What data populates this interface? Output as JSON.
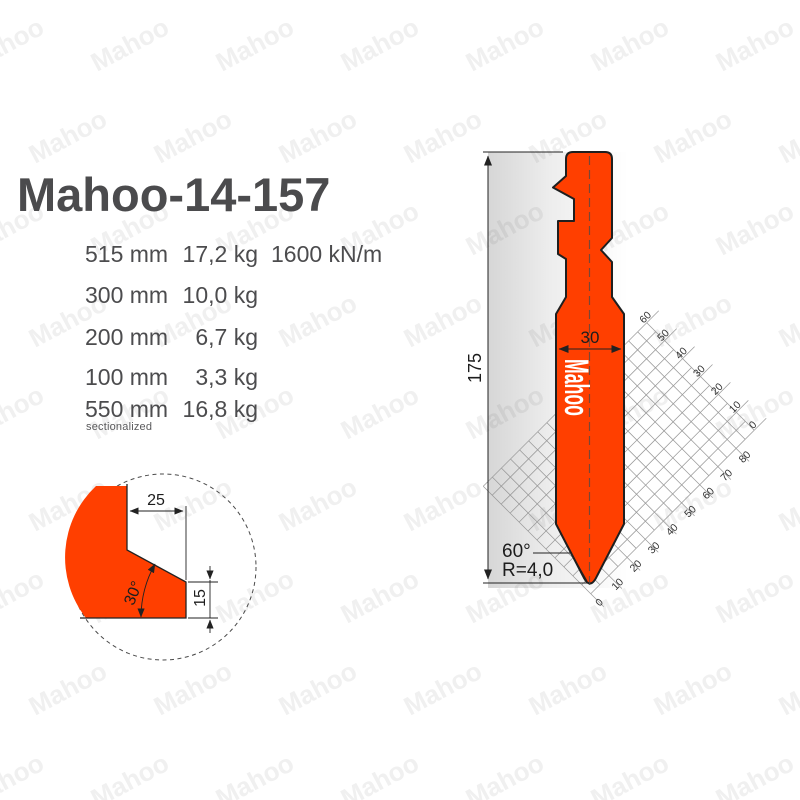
{
  "title": "Mahoo-14-157",
  "specs": {
    "rows": [
      {
        "length": "515 mm",
        "weight": "17,2 kg",
        "force": "1600 kN/m",
        "note": ""
      },
      {
        "length": "300 mm",
        "weight": "10,0 kg",
        "force": "",
        "note": ""
      },
      {
        "length": "200 mm",
        "weight": "6,7 kg",
        "force": "",
        "note": ""
      },
      {
        "length": "100 mm",
        "weight": "3,3 kg",
        "force": "",
        "note": ""
      },
      {
        "length": "550 mm",
        "weight": "16,8 kg",
        "force": "",
        "note": "sectionalized"
      }
    ]
  },
  "detail_view": {
    "width_label": "25",
    "angle_label": "30°",
    "height_label": "15"
  },
  "drawing": {
    "dimensions": {
      "height": "175",
      "width": "30",
      "tip_angle": "60°",
      "tip_radius": "R=4,0"
    },
    "body_logo": "Mahoo",
    "grid": {
      "upper_axis_labels": [
        "60",
        "50",
        "40",
        "30",
        "20",
        "10",
        "0"
      ],
      "lower_axis_labels": [
        "0",
        "10",
        "20",
        "30",
        "40",
        "50",
        "60",
        "70",
        "80"
      ]
    }
  },
  "watermark": {
    "text": "Mahoo"
  },
  "colors": {
    "tool_orange": "#FF3F00",
    "outline": "#1f1f1f",
    "text_gray": "#4b4b4d",
    "grid_gray": "#999999",
    "watermark_gray": "#f0f0f0"
  }
}
